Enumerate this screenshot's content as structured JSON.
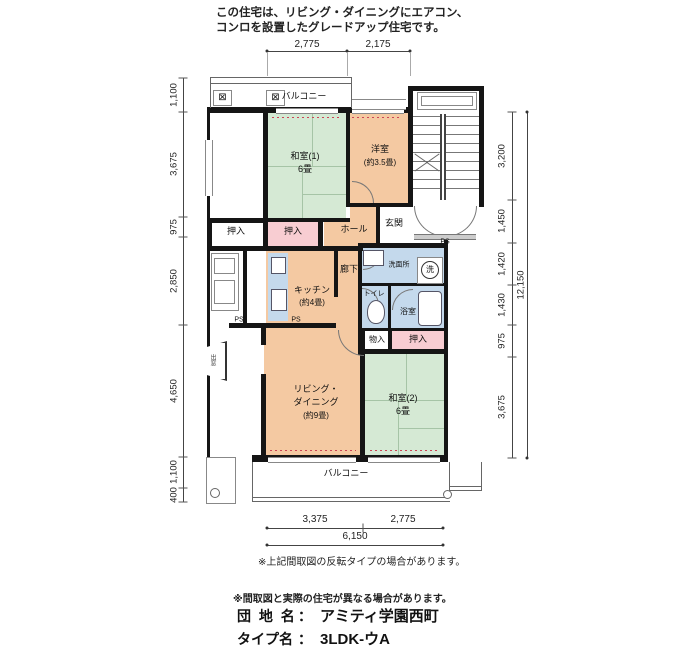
{
  "header": {
    "line1": "この住宅は、リビング・ダイニングにエアコン、",
    "line2": "コンロを設置したグレードアップ住宅です。"
  },
  "plan": {
    "balcony_top": "バルコニー",
    "balcony_bottom": "バルコニー",
    "washitsu1_name": "和室(1)",
    "washitsu1_size": "6畳",
    "youshitsu_name": "洋室",
    "youshitsu_size": "(約3.5畳)",
    "washitsu2_name": "和室(2)",
    "washitsu2_size": "6畳",
    "living_line1": "リビング・",
    "living_line2": "ダイニング",
    "living_line3": "(約9畳)",
    "kitchen_name": "キッチン",
    "kitchen_size": "(約4畳)",
    "hall": "ホール",
    "genkan": "玄関",
    "rouka": "廊下",
    "senmenjo": "洗面所",
    "toilet": "トイレ",
    "bath": "浴室",
    "oshiire": "押入",
    "monoire": "物入",
    "demado": "出窓",
    "ps": "PS",
    "washer": "洗",
    "ac_icon": "⊠"
  },
  "dimensions": {
    "top": [
      "2,775",
      "2,175"
    ],
    "left": [
      "1,100",
      "3,675",
      "975",
      "2,850",
      "4,650",
      "1,100",
      "400"
    ],
    "right": [
      "3,200",
      "1,450",
      "1,420",
      "1,430",
      "975",
      "3,675"
    ],
    "right_total": "12,150",
    "bottom": [
      "3,375",
      "2,775"
    ],
    "bottom_total": "6,150"
  },
  "notes": {
    "flip": "※上記間取図の反転タイプの場合があります。",
    "differ": "※間取図と実際の住宅が異なる場合があります。"
  },
  "footer": {
    "estate_label": "団 地 名",
    "separator": "：",
    "estate_name": "アミティ学園西町",
    "type_label": "タイプ名",
    "type_value": "3LDK-ウA"
  },
  "colors": {
    "tatami": "#d5e9d4",
    "western": "#f4c9a2",
    "wet": "#c4d9ec",
    "closet": "#f8cdd2",
    "wall": "#151515"
  }
}
